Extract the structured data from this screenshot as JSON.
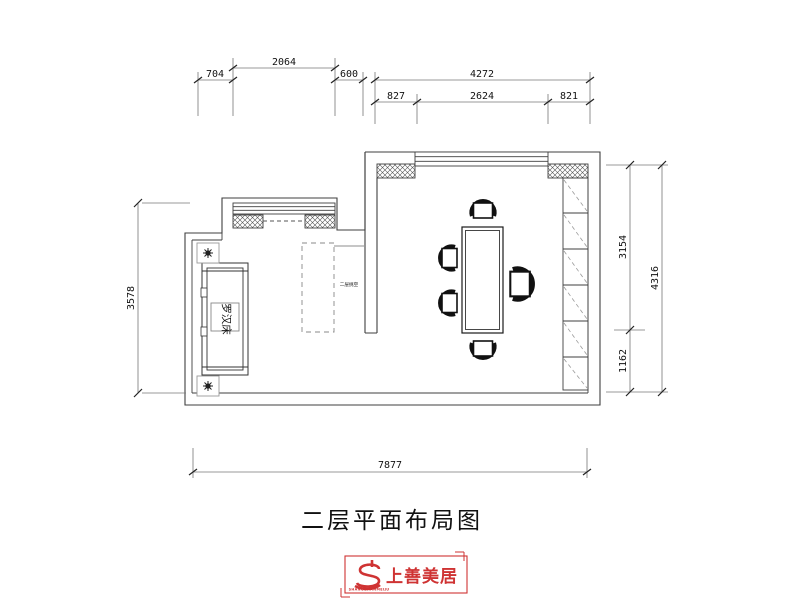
{
  "title": {
    "text": "二层平面布局图"
  },
  "plan": {
    "bed_label": "罗汉床",
    "void_label": "二层挑空"
  },
  "dimensions": {
    "top": {
      "d704": "704",
      "d2064": "2064",
      "d600": "600",
      "d4272": "4272",
      "d827": "827",
      "d2624": "2624",
      "d821": "821"
    },
    "right": {
      "d3154": "3154",
      "d1162": "1162",
      "d4316": "4316"
    },
    "left": {
      "d3578": "3578"
    },
    "bottom": {
      "d7877": "7877"
    }
  },
  "logo": {
    "brand": "上善美居",
    "subtext": "SHANGSHANMEIJU",
    "accent_color": "#cf3333"
  }
}
